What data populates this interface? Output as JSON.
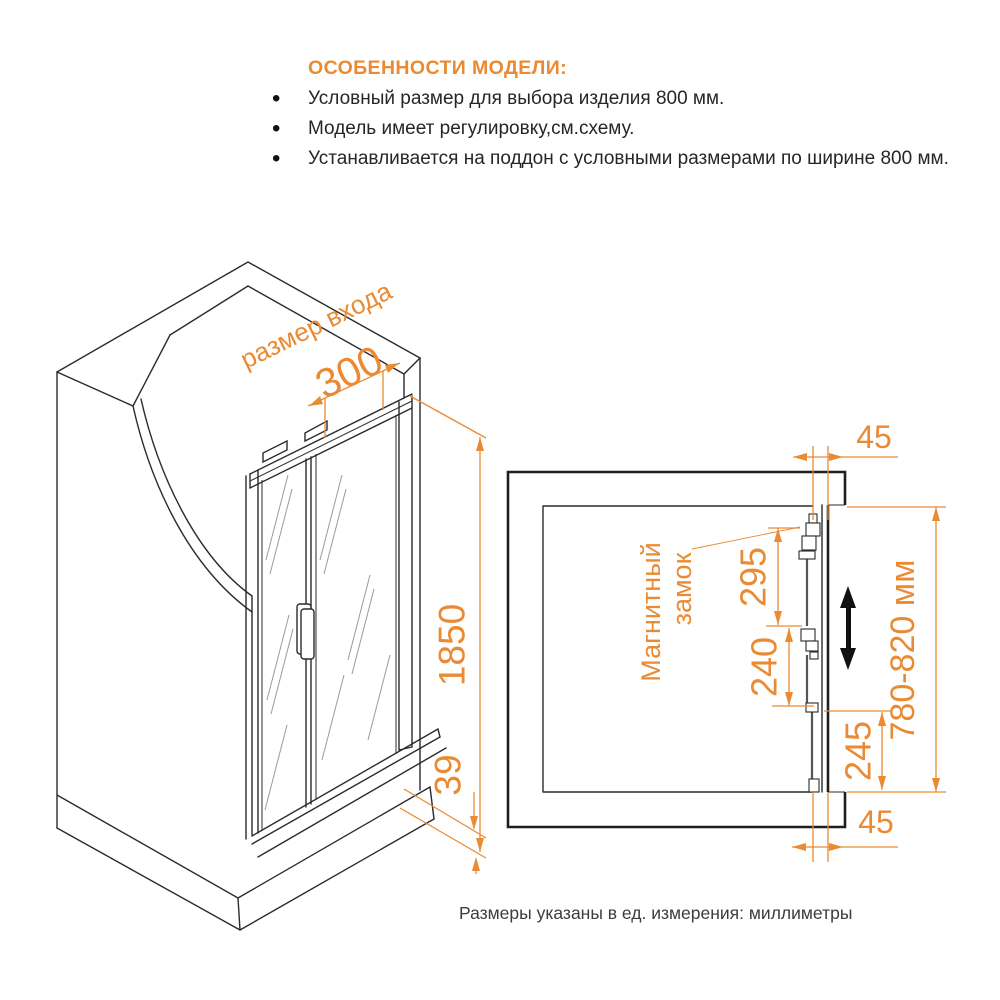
{
  "colors": {
    "accent": "#EA8A32",
    "line": "#2b2b2b",
    "text": "#262626"
  },
  "header": {
    "title": "ОСОБЕННОСТИ МОДЕЛИ:",
    "bullets": [
      "Условный размер для выбора изделия 800 мм.",
      "Модель имеет регулировку,см.схему.",
      "Устанавливается на поддон с условными размерами по ширине 800 мм."
    ]
  },
  "iso_view": {
    "entrance_label": "размер входа",
    "dim_entrance": "300",
    "dim_height": "1850",
    "dim_threshold": "39"
  },
  "top_view": {
    "dim_top_offset": "45",
    "dim_bottom_offset": "45",
    "dim_lock_top": "295",
    "dim_lock_middle": "240",
    "dim_lock_bottom": "245",
    "dim_width_range": "780-820 мм",
    "lock_label_line1": "Магнитный",
    "lock_label_line2": "замок"
  },
  "footer": {
    "note": "Размеры указаны в ед. измерения: миллиметры"
  }
}
